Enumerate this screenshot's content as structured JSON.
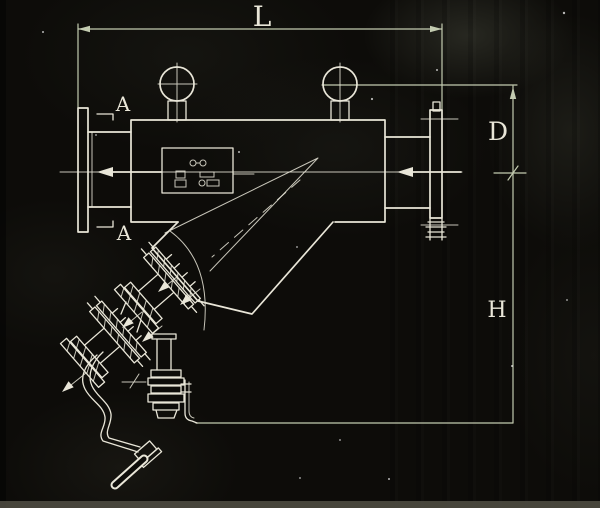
{
  "labels": {
    "length": "L",
    "diameter": "D",
    "height": "H",
    "section_top": "A",
    "section_bottom": "A"
  },
  "colors": {
    "line": "#e9e6d8",
    "dim": "#c3cbb0",
    "bg": "#0d0c09"
  }
}
